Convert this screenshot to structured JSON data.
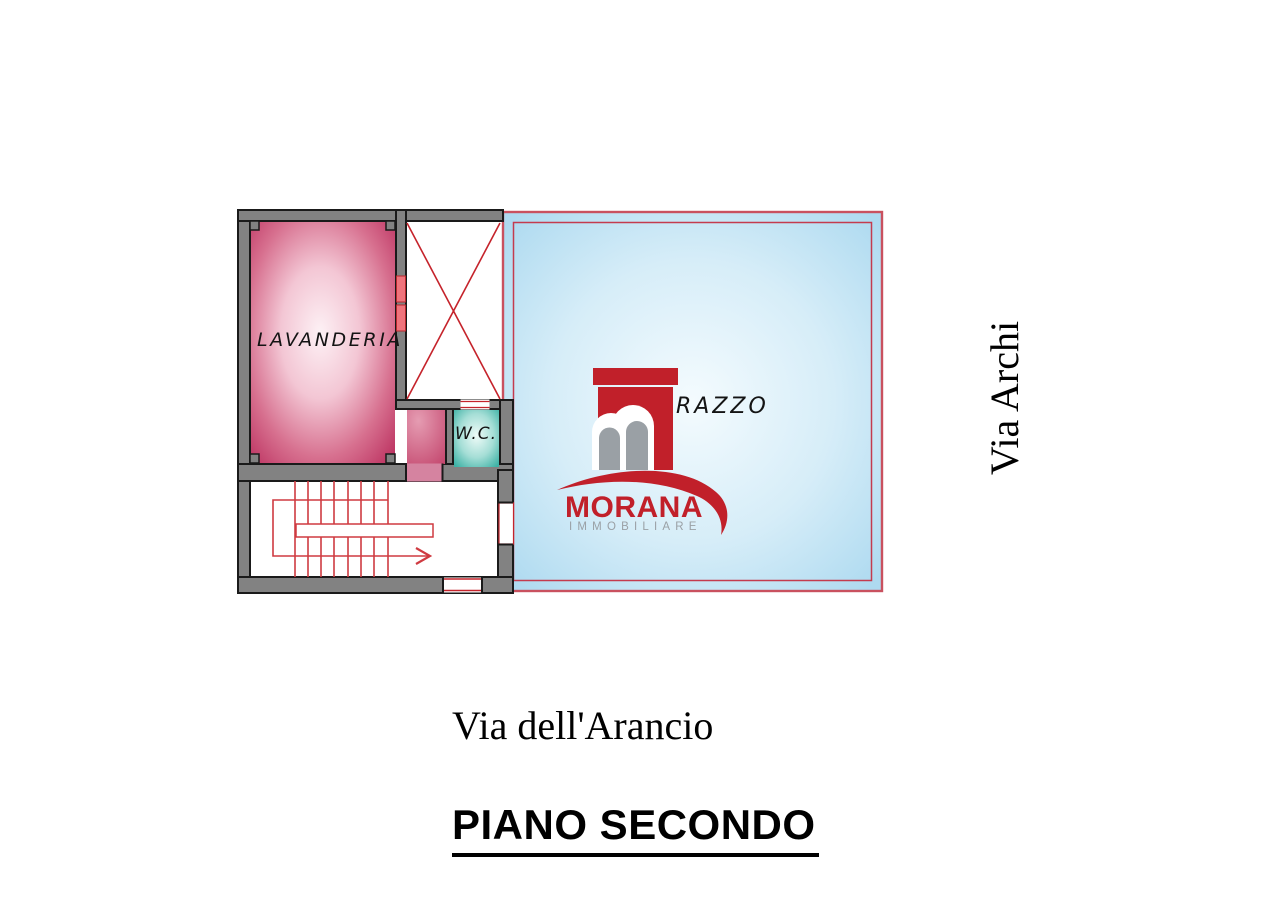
{
  "plan": {
    "rooms": {
      "lavanderia": {
        "label": "LAVANDERIA",
        "edge_color": "#c23a67"
      },
      "wc": {
        "label": "W.C.",
        "edge_color": "#3eb2a6"
      },
      "terrace": {
        "label_partial": "RAZZO",
        "fill_edge": "#b0dbf1",
        "fill_center": "#f2fafd"
      },
      "shaft": {
        "marking": "red-cross"
      },
      "stairwell": {
        "marking": "treads-with-up-arrow"
      }
    },
    "colors": {
      "wall_gray": "#828282",
      "wall_outline": "#1a1a1a",
      "red_line": "#c5232b",
      "terrace_border_outer": "#c9515f",
      "terrace_border_inner": "#c43b4e",
      "window_salmon": "#ef747c",
      "door_pink": "#d583a0"
    }
  },
  "logo": {
    "name": "MORANA",
    "subtitle": "IMMOBILIARE",
    "red": "#c1202a",
    "gray": "#9aa0a5"
  },
  "streets": {
    "right": "Via Archi",
    "bottom": "Via dell'Arancio"
  },
  "title": {
    "floor": "PIANO SECONDO"
  }
}
